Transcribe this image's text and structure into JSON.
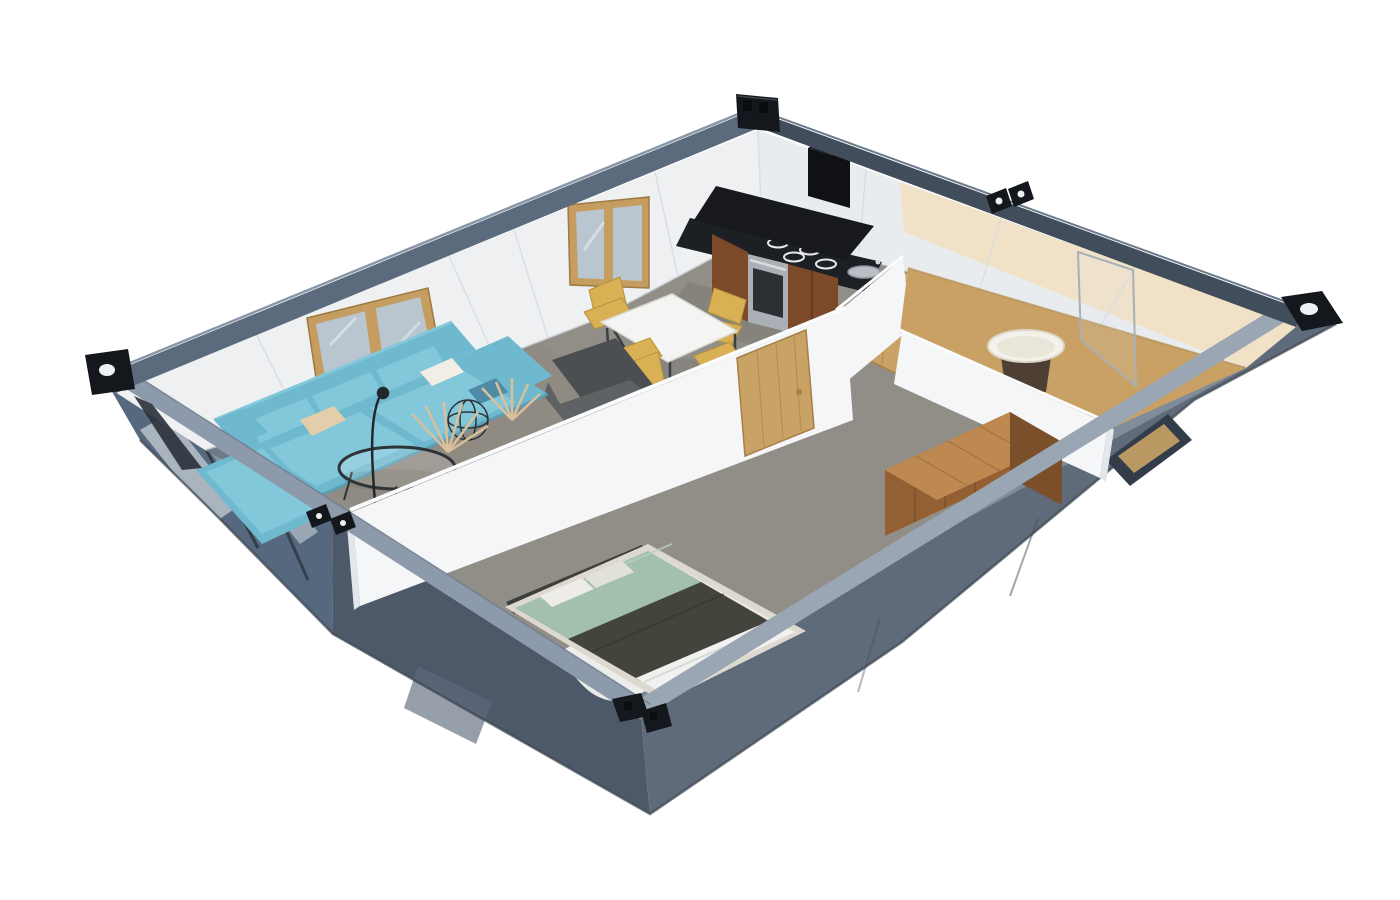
{
  "canvas": {
    "width": 1400,
    "height": 900,
    "background": "#ffffff"
  },
  "scene": {
    "subject": "container-house-isometric-cutaway-render",
    "rooms": [
      "living-room",
      "dining-area",
      "kitchen",
      "bedroom",
      "bathroom"
    ],
    "furniture": [
      "teal-sectional-sofa",
      "wire-coffee-table",
      "gray-armchair",
      "white-dining-table",
      "yellow-dining-chairs",
      "range-hood",
      "gas-cooktop",
      "oven",
      "sink",
      "double-bed",
      "wardrobe",
      "round-wash-basin",
      "shower-screen"
    ],
    "features": [
      "black-corner-castings",
      "rail-connectors",
      "wood-framed-windows",
      "oak-doors",
      "glass-end-wall",
      "small-right-wall-window"
    ]
  },
  "palette": {
    "railLight": "#8d9aab",
    "railLighter": "#9aa6b4",
    "railUL": "#5b6a7c",
    "railUR": "#414d5b",
    "railTopLine": "#8796a8",
    "railTopLine2": "#6b7a8c",
    "railInnerLine": "#6e7b8c",
    "wallOuterDark": "#4d5969",
    "wallOuterMid": "#5f6b7a",
    "panelRecess": "#5d6a7c",
    "wallInnerLL": "#6d7988",
    "wallInnerLR": "#808c9a",
    "glassEnd": "#55687e",
    "glassStreak": "#ffffff",
    "seamOuter": "#46525f",
    "baseEdge": "#39434f",
    "casting": "#14171c",
    "castingHole": "#eef0f2",
    "holeDark": "#0a0c10",
    "castingEdge": "#3c434c",
    "braceDark": "#2a3038",
    "wallWhite": "#eef0f2",
    "wallWhite2": "#e9ecef",
    "wallSeam": "#d7dbdf",
    "baseboard": "#cfd4d8",
    "warmWall": "#f1e1c3",
    "floorMain": "#918e88",
    "floorWarm": "#8e877c",
    "floorKitchen": "#827f79",
    "floorBath": "#c9a164",
    "floorBathEdge": "#b08a4e",
    "towelWhite": "#f2f2f0",
    "partition": "#f5f6f8",
    "partitionShade": "#e3e6ea",
    "partitionTop": "#fbfcfd",
    "doorOak": "#c9a265",
    "doorOakDark": "#a87f48",
    "windowFrame": "#c69d60",
    "windowFrameDark": "#9e7a42",
    "windowGlass": "#b9c6cf",
    "sofa": "#6fb9cf",
    "sofaLight": "#82c8da",
    "sofaDark": "#569db8",
    "pillowTeal": "#4f8aa6",
    "cushionBeige": "#e3cdaa",
    "cushionWhite": "#f2eee6",
    "wireTable": "#2e3337",
    "fanDecor": "#d9c09a",
    "lampDark": "#23272b",
    "armchair": "#5f6264",
    "armchairDark": "#4c4f51",
    "tableTop": "#f4f4f2",
    "tableEdge": "#d8d8d4",
    "legDark": "#3a3e42",
    "chairYellow": "#d9b154",
    "chairYellowDark": "#b89340",
    "counterBlack": "#1c1f24",
    "burnerRing": "#e8e8e6",
    "hoodBlack": "#17191d",
    "ductBlack": "#0f1115",
    "ductTop": "#1d2126",
    "cabinetWood": "#7c4a28",
    "cabinetWoodDark": "#5e3319",
    "ovenSteel": "#aab0b5",
    "ovenGlass": "#2c2f33",
    "steelLight": "#d8dcdf",
    "sinkSteel": "#b9bfc4",
    "sinkEdge": "#8d949a",
    "bedFrame": "#ded9cf",
    "bedBase": "#e9e7df",
    "mattressSage": "#a3bfae",
    "sageFold": "#b8cfc2",
    "blanketDark": "#43453d",
    "blanketFold": "#2f312b",
    "sheetWhite": "#f1f2f0",
    "sheetFold": "#d8dad6",
    "pillow": "#edece6",
    "pillow2": "#e2e1d9",
    "headboard": "#3c3f3a",
    "wardrobeTop": "#bd8951",
    "wardrobeTopLine": "#9a6c3e",
    "wardrobeFront": "#935f33",
    "wardrobeEnd": "#7a4f2a",
    "wardrobeGrain": "#6f4826",
    "basinTop": "#f4f1ea",
    "basinInner": "#eae5d9",
    "basinEdge": "#ddd6c8",
    "basinBody": "#4e3f35",
    "showerGlass": "#a8b0b6",
    "showerFill": "#dce4e8",
    "mirrorWood": "#d9b87c",
    "diamondRecess": "#333d49",
    "shadow": "#000000"
  }
}
